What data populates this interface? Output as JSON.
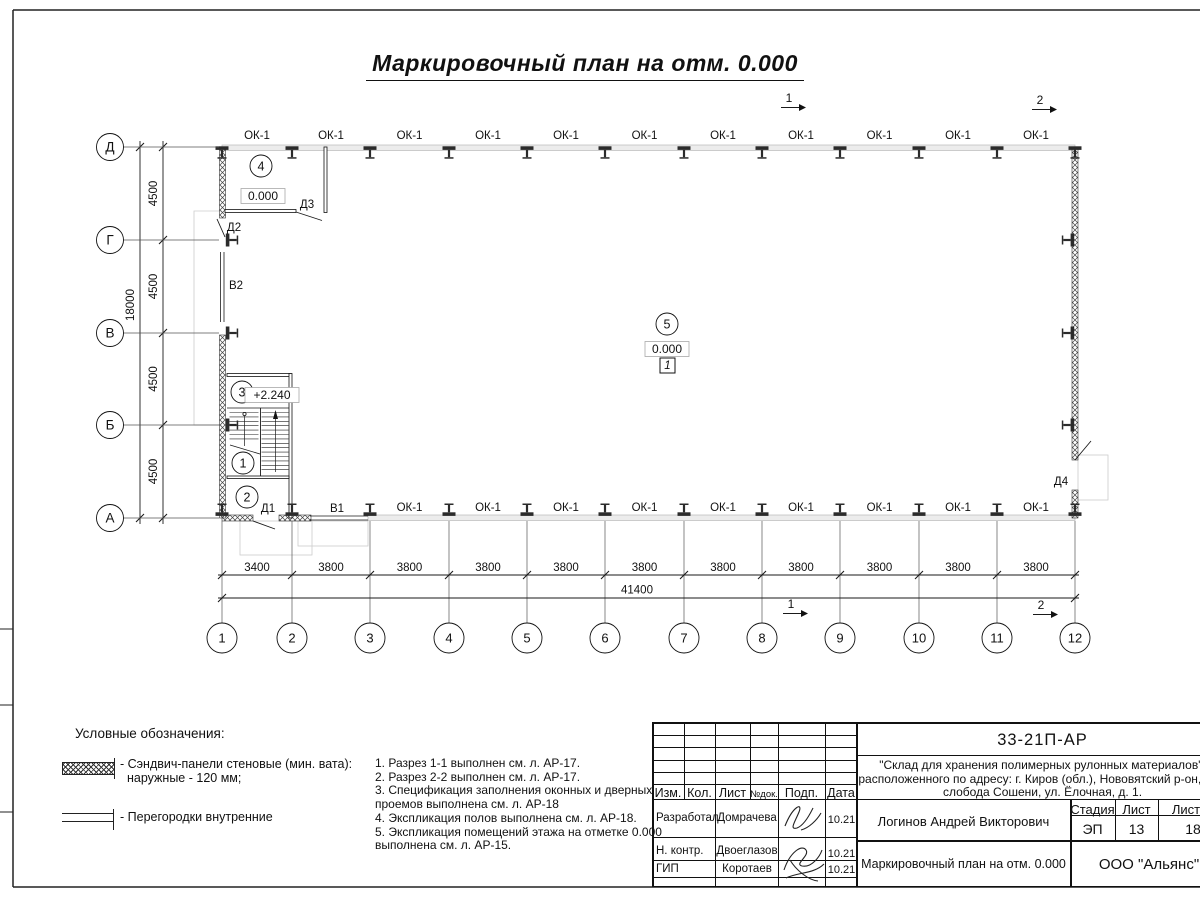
{
  "sheet_title": "Маркировочный план на отм. 0.000",
  "plan": {
    "axis_letters": [
      "Д",
      "Г",
      "В",
      "Б",
      "А"
    ],
    "axis_numbers": [
      "1",
      "2",
      "3",
      "4",
      "5",
      "6",
      "7",
      "8",
      "9",
      "10",
      "11",
      "12"
    ],
    "left_dims": [
      "4500",
      "4500",
      "4500",
      "4500"
    ],
    "left_total_dim": "18000",
    "bottom_dims": [
      "3400",
      "3800",
      "3800",
      "3800",
      "3800",
      "3800",
      "3800",
      "3800",
      "3800",
      "3800",
      "3800"
    ],
    "bottom_total_dim": "41400",
    "window_mark": "ОК-1",
    "door_marks": [
      "Д1",
      "Д2",
      "Д3",
      "Д4",
      "В1",
      "В2"
    ],
    "rooms": [
      {
        "num": "4",
        "elevation": "0.000"
      },
      {
        "num": "3",
        "elevation": "+2.240"
      },
      {
        "num": "1"
      },
      {
        "num": "2"
      },
      {
        "num": "5",
        "elevation": "0.000",
        "floor_mark": "1"
      }
    ],
    "section_marks": [
      "1",
      "2"
    ]
  },
  "legend": {
    "heading": "Условные обозначения:",
    "item1_line1": "- Сэндвич-панели стеновые (мин. вата):",
    "item1_line2": "наружные - 120 мм;",
    "item2_label": "- Перегородки внутренние"
  },
  "notes": [
    "1. Разрез 1-1 выполнен см. л. АР-17.",
    "2. Разрез 2-2 выполнен см. л. АР-17.",
    "3. Спецификация заполнения оконных и дверных проемов выполнена см. л. АР-18",
    "4. Экспликация полов выполнена см. л. АР-18.",
    "5. Экспликация помещений этажа на отметке 0.000 выполнена см. л. АР-15."
  ],
  "title_block": {
    "doc_number": "33-21П-АР",
    "project_desc_lines": [
      "\"Склад для хранения полимерных рулонных материалов\",",
      "расположенного по адресу: г. Киров (обл.), Нововятский р-он, тер.",
      "слобода Сошени, ул. Ёлочная, д. 1."
    ],
    "columns": [
      "Изм.",
      "Кол.",
      "Лист",
      "№док.",
      "Подп.",
      "Дата"
    ],
    "sign_rows": [
      {
        "role": "Разработал",
        "name": "Домрачева",
        "date": "10.21"
      },
      {
        "role": "Н. контр.",
        "name": "Двоеглазов",
        "date": "10.21"
      },
      {
        "role": "ГИП",
        "name": "Коротаев",
        "date": "10.21"
      }
    ],
    "approved_by": "Логинов Андрей Викторович",
    "stage_label": "Стадия",
    "sheet_label": "Лист",
    "sheets_label": "Листов",
    "stage": "ЭП",
    "sheet_no": "13",
    "sheets_total": "18",
    "drawing_title": "Маркировочный план на отм. 0.000",
    "company": "ООО \"Альянс\""
  }
}
